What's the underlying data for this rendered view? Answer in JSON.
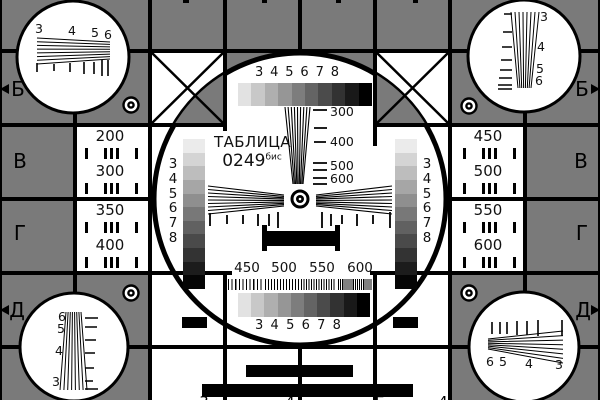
{
  "colors": {
    "background_gray": "#7a7a7a",
    "line_black": "#000000",
    "card_white": "#ffffff"
  },
  "center": {
    "title": "ТАБЛИЦА",
    "code": "0249",
    "code_sup": "бис",
    "grayscale_top_labels": [
      "3",
      "4",
      "5",
      "6",
      "7",
      "8"
    ],
    "grayscale_bottom_labels": [
      "3",
      "4",
      "5",
      "6",
      "7",
      "8"
    ],
    "grayscale_steps": [
      "#e2e2e2",
      "#c8c8c8",
      "#afafaf",
      "#969696",
      "#7d7d7d",
      "#646464",
      "#4b4b4b",
      "#323232",
      "#191919",
      "#000000"
    ],
    "vertical_scale_labels": [
      "300",
      "400",
      "500",
      "600"
    ],
    "burst_labels": [
      "450",
      "500",
      "550",
      "600"
    ],
    "burst_periods": [
      3.6,
      3.0,
      2.5,
      2.1
    ],
    "side_wedge_left_labels": [
      "3",
      "4",
      "5",
      "6",
      "7",
      "8"
    ],
    "side_wedge_right_labels": [
      "3",
      "4",
      "5",
      "6",
      "7",
      "8"
    ],
    "side_wedge_steps": [
      "#ebebeb",
      "#d4d4d4",
      "#bdbdbd",
      "#a6a6a6",
      "#8f8f8f",
      "#787878",
      "#616161",
      "#4a4a4a",
      "#333333",
      "#1c1c1c",
      "#050505"
    ]
  },
  "resolution_boxes": {
    "left": [
      {
        "top": "200",
        "bottom": "300"
      },
      {
        "top": "350",
        "bottom": "400"
      }
    ],
    "right": [
      {
        "top": "450",
        "bottom": "500"
      },
      {
        "top": "550",
        "bottom": "600"
      }
    ]
  },
  "row_letters": {
    "left": [
      "Б",
      "В",
      "Г",
      "Д"
    ],
    "right": [
      "Б",
      "В",
      "Г",
      "Д"
    ]
  },
  "corner_wedges": {
    "top_left": [
      "3",
      "4",
      "5",
      "6"
    ],
    "top_right": [
      "3",
      "4",
      "5",
      "6"
    ],
    "bottom_left": [
      "6",
      "5",
      "4",
      "3"
    ],
    "bottom_right": [
      "6",
      "5",
      "4",
      "3"
    ]
  },
  "edge_cropped_glyphs": {
    "bottom": [
      "3",
      "4",
      "Б",
      "4"
    ]
  }
}
